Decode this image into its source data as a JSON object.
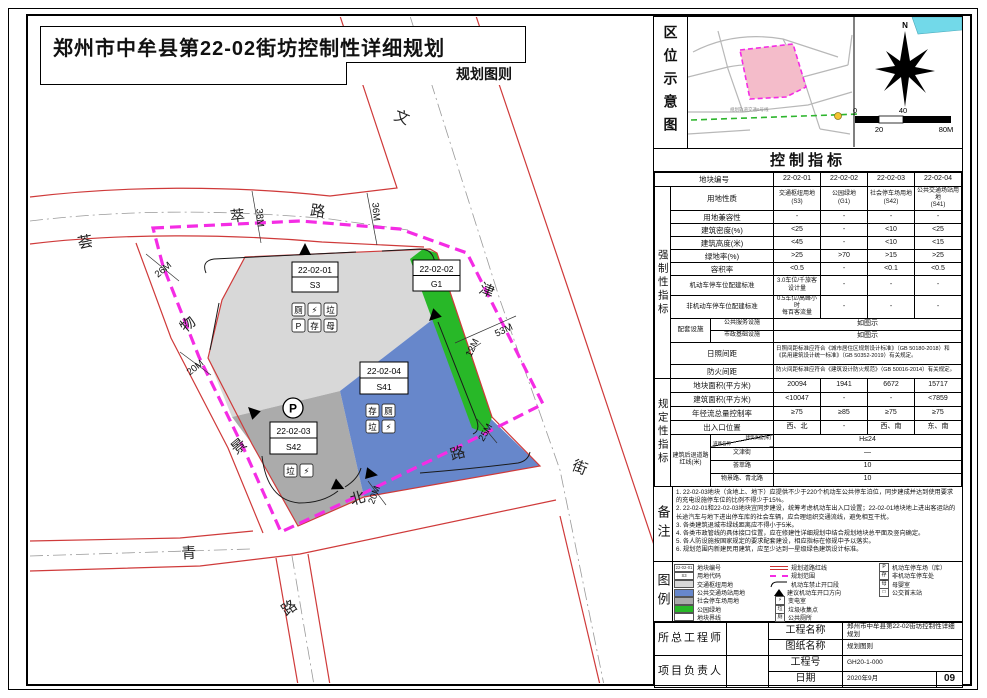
{
  "page": {
    "title": "郑州市中牟县第22-02街坊控制性详细规划",
    "subtitle": "规划图则"
  },
  "location_panel": {
    "label": "区位示意图",
    "compass": "N",
    "metro_note": "规划轨道交通6号线",
    "scale": {
      "zero": "0",
      "forty": "40",
      "twenty": "20",
      "eighty": "80M"
    }
  },
  "map": {
    "blocks": [
      {
        "id": "22-02-01",
        "code": "S3"
      },
      {
        "id": "22-02-02",
        "code": "G1"
      },
      {
        "id": "22-02-04",
        "code": "S41"
      },
      {
        "id": "22-02-03",
        "code": "S42"
      }
    ],
    "road_chars": [
      "文",
      "津",
      "街",
      "荟",
      "萃",
      "路",
      "物",
      "景",
      "路",
      "青",
      "北",
      "路"
    ],
    "dims": [
      "38M",
      "36M",
      "26M",
      "20M",
      "12M",
      "53M",
      "25M",
      "20M"
    ],
    "icons": {
      "s3": [
        "厕",
        "⚡",
        "垃",
        "P",
        "存",
        "母"
      ],
      "s41": [
        "存",
        "厕",
        "垃",
        "⚡"
      ],
      "s42": [
        "垃",
        "⚡"
      ],
      "s42_p": "P"
    },
    "colors": {
      "transport_hub": "#d8d8d8",
      "public_transit": "#6787cb",
      "parking": "#ababab",
      "green": "#28b828",
      "road_red": "#cf3a3a",
      "boundary_magenta": "#f42ce4"
    }
  },
  "indicators": {
    "title": "控制指标",
    "block_no_label": "地块编号",
    "block_ids": [
      "22-02-01",
      "22-02-02",
      "22-02-03",
      "22-02-04"
    ],
    "section1": "强制性指标",
    "section2": "规定性指标",
    "rows1": [
      {
        "label": "用地性质",
        "values": [
          "交通枢纽用地\n(S3)",
          "公园绿地\n(G1)",
          "社会停车场用地\n(S42)",
          "公共交通场站用地\n(S41)"
        ]
      },
      {
        "label": "用地兼容性",
        "values": [
          "-",
          "-",
          "-",
          "-"
        ]
      },
      {
        "label": "建筑密度(%)",
        "values": [
          "<25",
          "-",
          "<10",
          "<25"
        ]
      },
      {
        "label": "建筑高度(米)",
        "values": [
          "<45",
          "-",
          "<10",
          "<15"
        ]
      },
      {
        "label": "绿地率(%)",
        "values": [
          ">25",
          ">70",
          ">15",
          ">25"
        ]
      },
      {
        "label": "容积率",
        "values": [
          "<0.5",
          "-",
          "<0.1",
          "<0.5"
        ]
      },
      {
        "label": "机动车停车位配建标准",
        "values": [
          "3.0车位/千旅客\n设计量",
          "-",
          "-",
          "-"
        ]
      },
      {
        "label": "非机动车停车位配建标准",
        "values": [
          "0.5车位/高峰小时\n每百客流量",
          "-",
          "-",
          "-"
        ]
      }
    ],
    "peitao": {
      "label": "配套设施",
      "rows": [
        {
          "label": "公共服务设施",
          "value": "如图示"
        },
        {
          "label": "市政基础设施",
          "value": "如图示"
        }
      ]
    },
    "span_rows": [
      {
        "label": "日照间距",
        "value": "日照间距标准应符合《城市居住区规划设计标准》（GB 50180-2018）和《民用建筑设计统一标准》（GB 50352-2019）有关规定。"
      },
      {
        "label": "防火间距",
        "value": "防火间距标准应符合《建筑设计防火规范》（GB 50016-2014）有关规定。"
      }
    ],
    "rows2": [
      {
        "label": "地块面积(平方米)",
        "values": [
          "20094",
          "1941",
          "6672",
          "15717"
        ]
      },
      {
        "label": "建筑面积(平方米)",
        "values": [
          "<10047",
          "-",
          "-",
          "<7859"
        ]
      },
      {
        "label": "年径流总量控制率",
        "values": [
          "≥75",
          "≥85",
          "≥75",
          "≥75"
        ]
      },
      {
        "label": "出入口位置",
        "values": [
          "西、北",
          "-",
          "西、南",
          "东、南"
        ]
      }
    ],
    "setback": {
      "label": "建筑后退道路红线(米)",
      "corner_top": "建筑高度(米)",
      "corner_bottom": "道路名称",
      "height_value": "H≤24",
      "roads": [
        {
          "name": "文津街",
          "value": "—"
        },
        {
          "name": "荟萃路",
          "value": "10"
        },
        {
          "name": "物景路、青北路",
          "value": "10"
        }
      ]
    }
  },
  "notes": {
    "label": "备注",
    "items": [
      "1. 22-02-03地块（含地上、地下）应提供不少于220个机动车公共停车泊位，同步建成并达到使用要求的充电设施停车位的比例不得少于15%。",
      "2. 22-02-01和22-02-03地块宜同步建设，统筹考虑机动车出入口设置；22-02-01地块地上进出客运站的长途汽车与地下进出停车库的社会车辆，应合理组织交通流线，避免相互干扰。",
      "3. 各类建筑退城市绿线距离应不得小于5米。",
      "4. 各类市政管线的具体接口位置，应在修建性详细规划中结合规划地块总平面及竖向确定。",
      "5. 各人防设施按国家规定的要求配套建设，相应指标在修规中予以落实。",
      "6. 规划范围内新建民用建筑，应至少达到一星级绿色建筑设计标准。"
    ]
  },
  "legend": {
    "label": "图例",
    "col1": [
      {
        "type": "idbox",
        "text": "22-02-01",
        "label": "地块编号"
      },
      {
        "type": "codebox",
        "text": "S3",
        "label": "用地代码"
      },
      {
        "type": "fill",
        "color": "#d8d8d8",
        "label": "交通枢纽用地"
      },
      {
        "type": "fill",
        "color": "#6787cb",
        "label": "公共交通场站用地"
      },
      {
        "type": "fill",
        "color": "#ababab",
        "label": "社会停车场用地"
      },
      {
        "type": "fill",
        "color": "#28b828",
        "label": "公园绿地"
      },
      {
        "type": "fill",
        "color": "#ffffff",
        "label": "地块界线"
      }
    ],
    "col2": [
      {
        "type": "dline",
        "label": "规划道路红线"
      },
      {
        "type": "mdash",
        "label": "规划范围"
      },
      {
        "type": "curve",
        "label": "机动车禁止开口段"
      },
      {
        "type": "tri",
        "label": "建议机动车开口方向"
      },
      {
        "type": "glyph",
        "glyph": "⚡",
        "label": "变电室"
      },
      {
        "type": "glyph",
        "glyph": "垃",
        "label": "垃圾收集点"
      },
      {
        "type": "glyph",
        "glyph": "厕",
        "label": "公共厕所"
      }
    ],
    "col3": [
      {
        "type": "glyph",
        "glyph": "P",
        "label": "机动车停车场（库）"
      },
      {
        "type": "glyph",
        "glyph": "存",
        "label": "非机动车停车处"
      },
      {
        "type": "glyph",
        "glyph": "母",
        "label": "母婴室"
      },
      {
        "type": "glyph",
        "glyph": "□",
        "label": "公交首末站"
      }
    ]
  },
  "titleblock": {
    "chief": "所总工程师",
    "pm": "项目负责人",
    "rows": [
      {
        "label": "工程名称",
        "value": "郑州市中牟县第22-02街坊控制性详细规划"
      },
      {
        "label": "图纸名称",
        "value": "规划图则"
      },
      {
        "label": "工程号",
        "value": "GH20-1-000"
      },
      {
        "label": "日期",
        "value": "2020年9月"
      }
    ],
    "sheet": "09"
  }
}
